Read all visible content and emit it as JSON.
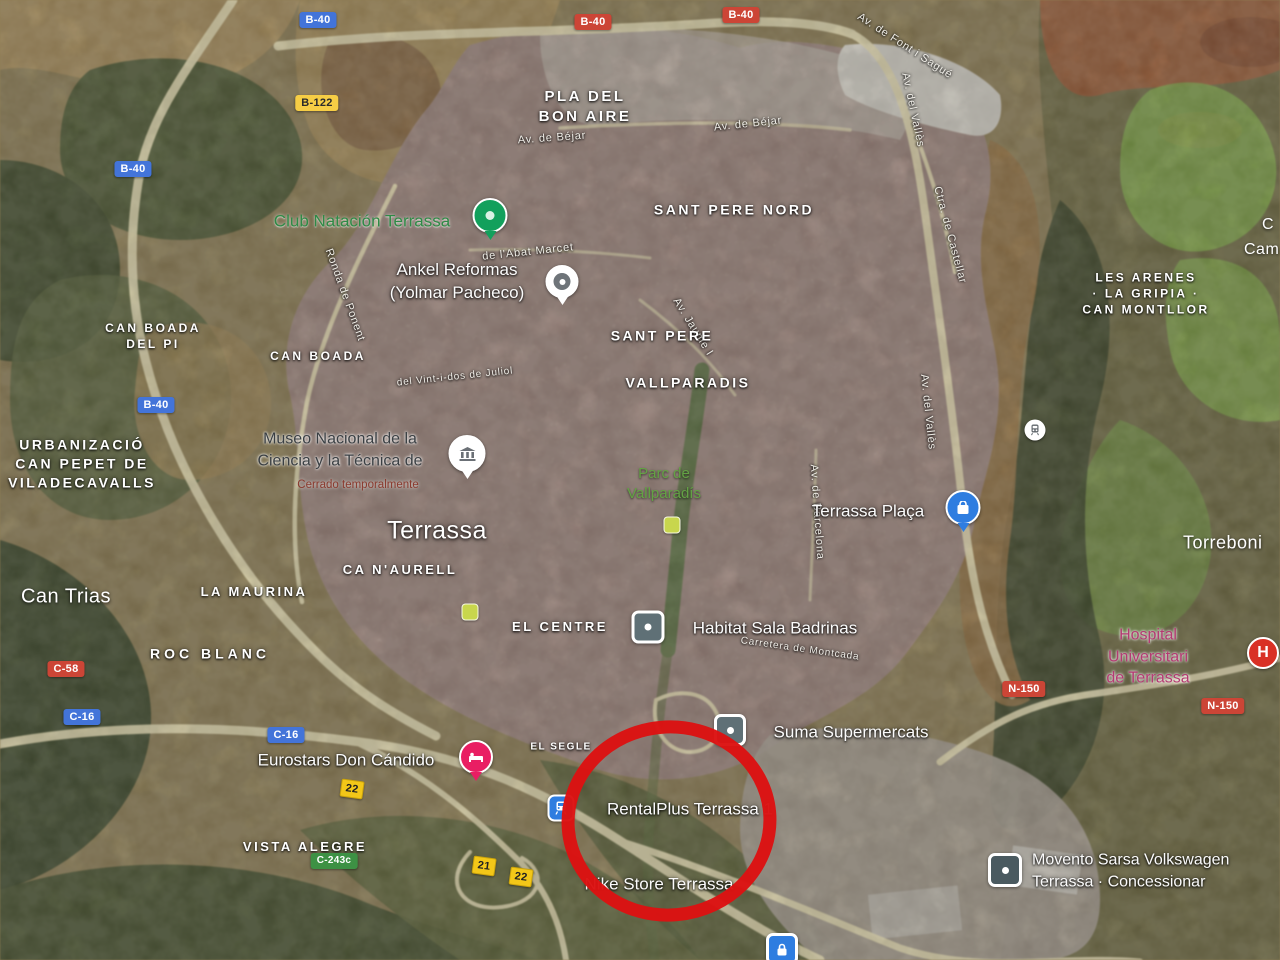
{
  "map_type": "satellite",
  "city": {
    "label": "Terrassa"
  },
  "districts": {
    "pla_del_bon_aire": "PLA DEL\nBON AIRE",
    "sant_pere_nord": "SANT PERE NORD",
    "sant_pere": "SANT PERE",
    "vallparadis": "VALLPARADIS",
    "can_boada": "CAN BOADA",
    "can_boada_del_pi": "CAN BOADA\nDEL PI",
    "les_arenes_la_gripia_can_montllor": "LES ARENES\n· LA GRIPIA ·\nCAN MONTLLOR",
    "urbanitzacio_can_pepet": "URBANIZACIÓ\nCAN PEPET DE\nVILADECAVALLS",
    "ca_n_aurell": "CA N'AURELL",
    "la_maurina": "LA MAURINA",
    "roc_blanc": "ROC BLANC",
    "el_centre": "EL CENTRE",
    "el_segle": "EL SEGLE",
    "vista_alegre": "VISTA ALEGRE",
    "can_trias": "Can Trias",
    "torrebonica": "Torreboni",
    "edge_partial_top": "C",
    "edge_partial_bottom": "Cam"
  },
  "pois": {
    "club_natacio": {
      "label": "Club Natación Terrassa"
    },
    "ankel": {
      "label": "Ankel Reformas\n(Yolmar Pacheco)"
    },
    "museu": {
      "label": "Museo Nacional de la\nCiencia y la Técnica de",
      "status": "Cerrado temporalmente"
    },
    "parc_vallparadis": {
      "label": "Parc de\nVallparadís"
    },
    "terrassa_placa": {
      "label": "Terrassa Plaça"
    },
    "habitat": {
      "label": "Habitat Sala Badrinas"
    },
    "suma": {
      "label": "Suma Supermercats"
    },
    "eurostars": {
      "label": "Eurostars Don Cándido"
    },
    "rentalplus": {
      "label": "RentalPlus Terrassa 1"
    },
    "nike": {
      "label": "Nike Store Terrassa"
    },
    "hospital": {
      "label": "Hospital Universitari\nde Terrassa",
      "icon_letter": "H"
    },
    "movento": {
      "label": "Movento Sarsa Volkswagen\nTerrassa · Concessionar"
    }
  },
  "streets": {
    "av_font_sague": "Av. de Font i Sagué",
    "av_del_valles_top": "Av. del Vallès",
    "ctra_castellar": "Ctra. de Castellar",
    "av_bejar_west": "Av. de Béjar",
    "av_bejar_east": "Av. de Béjar",
    "ronda_ponent": "Ronda de Ponent",
    "abat_marcet": "de l'Abat Marcet",
    "vint_i_dos_juliol": "del Vint-i-dos de Juliol",
    "av_jaume_i": "Av. Jaume I",
    "av_del_valles_mid": "Av. del Vallès",
    "av_barcelona": "Av. de Barcelona",
    "ctra_montcada": "Carretera de Montcada"
  },
  "badges": {
    "b40_nw": "B-40",
    "b40_top_a": "B-40",
    "b40_top_b": "B-40",
    "b122": "B-122",
    "b40_w1": "B-40",
    "b40_w2": "B-40",
    "c58": "C-58",
    "c16_a": "C-16",
    "c16_b": "C-16",
    "n150_a": "N-150",
    "n150_b": "N-150",
    "c243c": "C-243c",
    "exit22_a": "22",
    "exit21": "21",
    "exit22_b": "22"
  },
  "annotation": {
    "shape": "hand-drawn circle",
    "target": "RentalPlus Terrassa area"
  },
  "colors": {
    "annotation_red": "#dc1212",
    "poi_green_text": "#2f8a46",
    "park_green_text": "#63a244",
    "hospital_pink_text": "#b43a72",
    "badge_blue": "#4374d9",
    "badge_red": "#cc4536",
    "badge_yellow": "#f6cd45",
    "badge_green": "#3d9144",
    "exit_yellow": "#f3c718",
    "pin_green": "#12a05c",
    "pin_blue": "#2e7de0",
    "pin_pink": "#e91e63",
    "hospital_red": "#d93025",
    "poi_gray_icon": "#5f7076"
  }
}
